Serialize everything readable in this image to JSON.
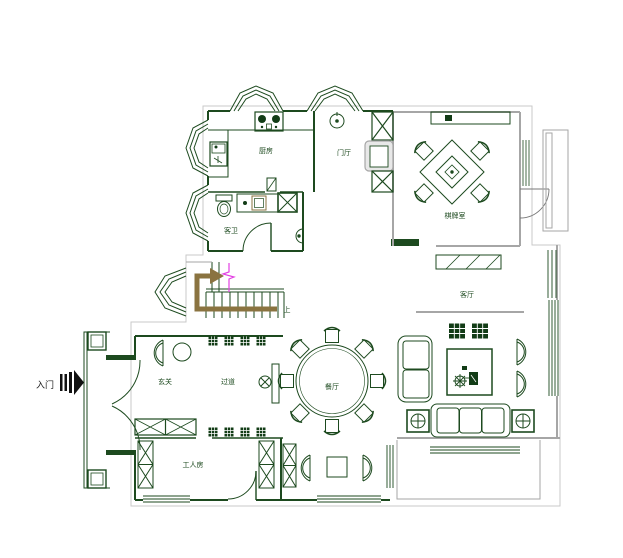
{
  "title": "residential-floor-plan-first-floor",
  "labels": {
    "entry": "入门",
    "kitchen": "厨房",
    "hall": "门厅",
    "bathroom": "客卫",
    "game_room": "棋牌室",
    "living_room": "客厅",
    "dining_room": "餐厅",
    "foyer": "玄关",
    "corridor": "过道",
    "servant_room": "工人房",
    "stairs_up": "上"
  },
  "icons": {
    "entry-arrow": "▶",
    "clock": "⊙",
    "plant": "⊗",
    "side-table-cross": "⊕",
    "stairs-up-arrow": "→",
    "shower-box": "⊠"
  },
  "colors": {
    "wall_green": "#1d4a1f",
    "wall_gray": "#a6a6a6",
    "outline_gray": "#c9c9c9",
    "furniture_fill": "#123c16",
    "stair_arrow_brown": "#8a7340",
    "break_line_magenta": "#e340e3",
    "background": "#ffffff"
  }
}
